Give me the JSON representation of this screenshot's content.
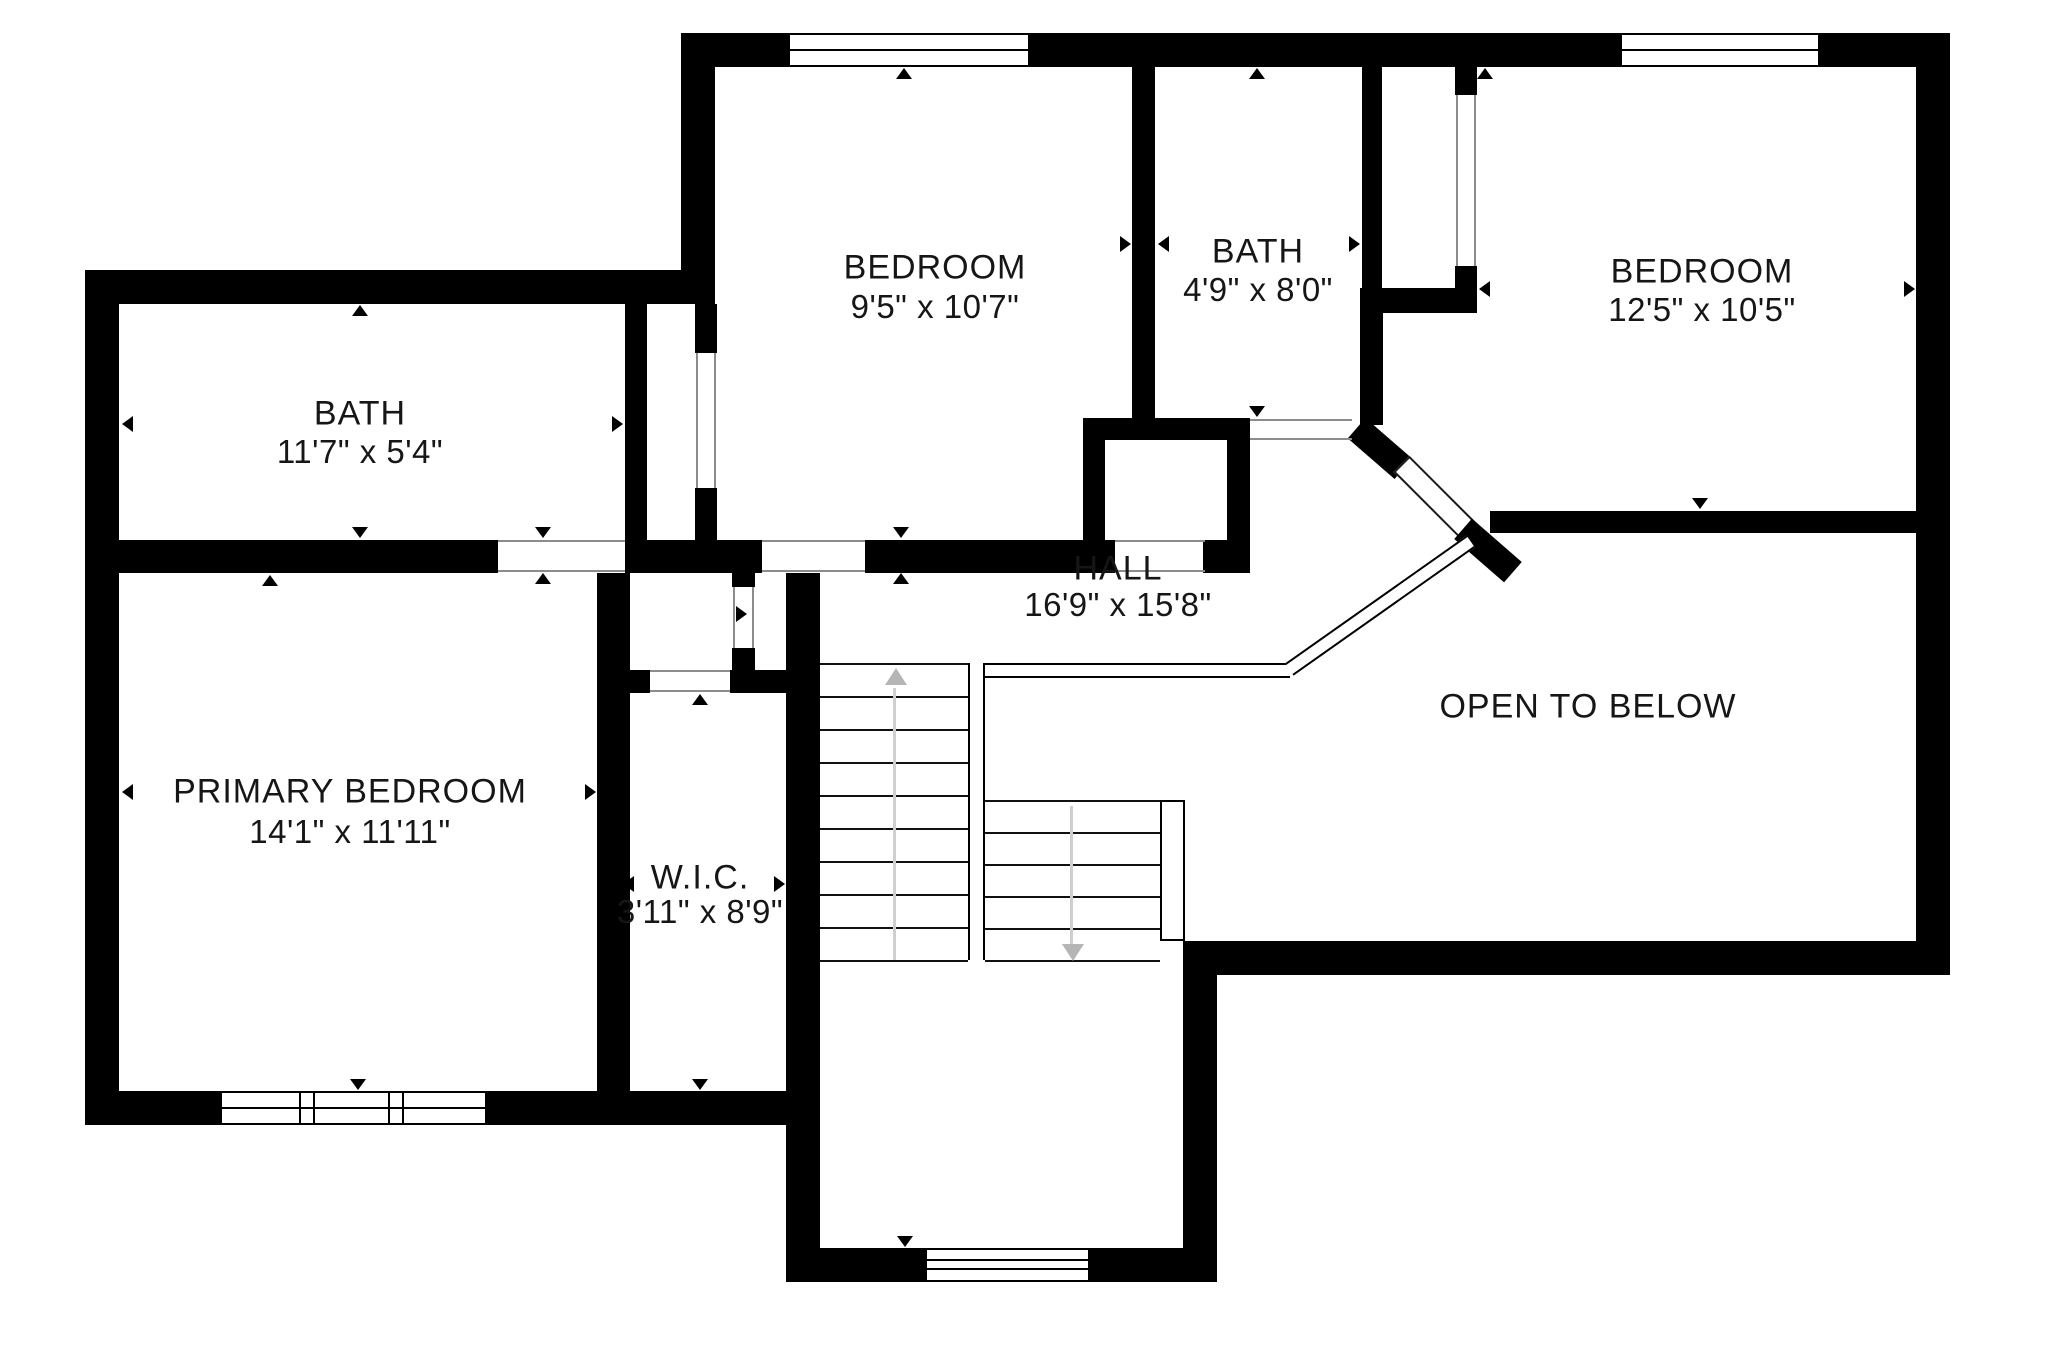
{
  "title": "Second floor plan",
  "style": {
    "background": "#ffffff",
    "wall_color": "#000000",
    "text_color": "#161616",
    "jamb_color": "#8c8c8c",
    "guide_stem_color": "#cfcfcf",
    "guide_head_color": "#b5b5b5"
  },
  "rooms": [
    {
      "id": "bath-upper-left",
      "name": "BATH",
      "dims": "11'7\" x 5'4\"",
      "label_x": 360,
      "name_y": 414,
      "dims_y": 452
    },
    {
      "id": "bedroom-middle",
      "name": "BEDROOM",
      "dims": "9'5\" x 10'7\"",
      "label_x": 935,
      "name_y": 268,
      "dims_y": 307
    },
    {
      "id": "bath-middle",
      "name": "BATH",
      "dims": "4'9\" x 8'0\"",
      "label_x": 1258,
      "name_y": 252,
      "dims_y": 290
    },
    {
      "id": "bedroom-right",
      "name": "BEDROOM",
      "dims": "12'5\" x 10'5\"",
      "label_x": 1702,
      "name_y": 272,
      "dims_y": 310
    },
    {
      "id": "hall",
      "name": "HALL",
      "dims": "16'9\" x 15'8\"",
      "label_x": 1118,
      "name_y": 569,
      "dims_y": 605
    },
    {
      "id": "open-to-below",
      "name": "OPEN TO BELOW",
      "dims": "",
      "label_x": 1588,
      "name_y": 707,
      "dims_y": 0
    },
    {
      "id": "primary-bedroom",
      "name": "PRIMARY BEDROOM",
      "dims": "14'1\" x 11'11\"",
      "label_x": 350,
      "name_y": 792,
      "dims_y": 832
    },
    {
      "id": "wic",
      "name": "W.I.C.",
      "dims": "3'11\" x 8'9\"",
      "label_x": 700,
      "name_y": 878,
      "dims_y": 912
    }
  ],
  "walls": [
    [
      85,
      270,
      34,
      855
    ],
    [
      85,
      270,
      630,
      34
    ],
    [
      85,
      1091,
      135,
      34
    ],
    [
      487,
      1091,
      333,
      34
    ],
    [
      681,
      33,
      34,
      271
    ],
    [
      681,
      33,
      107,
      34
    ],
    [
      1030,
      33,
      590,
      34
    ],
    [
      1820,
      33,
      130,
      34
    ],
    [
      1916,
      33,
      34,
      942
    ],
    [
      1183,
      941,
      767,
      34
    ],
    [
      1183,
      941,
      34,
      341
    ],
    [
      786,
      1248,
      139,
      34
    ],
    [
      1090,
      1248,
      127,
      34
    ],
    [
      786,
      1125,
      34,
      123
    ],
    [
      119,
      540,
      379,
      33
    ],
    [
      625,
      540,
      137,
      33
    ],
    [
      865,
      540,
      218,
      33
    ],
    [
      625,
      304,
      22,
      236
    ],
    [
      695,
      304,
      22,
      49
    ],
    [
      695,
      488,
      22,
      52
    ],
    [
      732,
      573,
      23,
      14
    ],
    [
      732,
      648,
      23,
      22
    ],
    [
      630,
      670,
      20,
      23
    ],
    [
      730,
      670,
      60,
      23
    ],
    [
      597,
      573,
      33,
      518
    ],
    [
      786,
      573,
      34,
      518
    ],
    [
      1132,
      67,
      23,
      351
    ],
    [
      1083,
      418,
      167,
      22
    ],
    [
      1083,
      440,
      22,
      133
    ],
    [
      1227,
      440,
      23,
      133
    ],
    [
      1083,
      540,
      32,
      33
    ],
    [
      1203,
      540,
      47,
      33
    ],
    [
      1362,
      67,
      20,
      221
    ],
    [
      1382,
      288,
      95,
      25
    ],
    [
      1455,
      67,
      22,
      28
    ],
    [
      1455,
      266,
      22,
      47
    ],
    [
      1360,
      288,
      23,
      137
    ],
    [
      1490,
      511,
      426,
      22
    ]
  ],
  "diagonal_walls": [
    {
      "x": 1349,
      "y": 435,
      "w": 62,
      "h": 27,
      "angle": 41,
      "kind": "wall"
    },
    {
      "x": 1387,
      "y": 487,
      "w": 98,
      "h": 23,
      "angle": 45,
      "kind": "door"
    },
    {
      "x": 1455,
      "y": 537,
      "w": 66,
      "h": 27,
      "angle": 41,
      "kind": "wall"
    }
  ],
  "windows": [
    {
      "x": 788,
      "y": 33,
      "w": 242,
      "h": 34,
      "type": "single"
    },
    {
      "x": 1620,
      "y": 33,
      "w": 200,
      "h": 34,
      "type": "single"
    },
    {
      "x": 220,
      "y": 1091,
      "w": 267,
      "h": 34,
      "type": "triple"
    },
    {
      "x": 925,
      "y": 1248,
      "w": 165,
      "h": 34,
      "type": "double-line"
    }
  ],
  "door_jambs": [
    [
      498,
      540,
      127,
      2
    ],
    [
      498,
      570,
      127,
      2
    ],
    [
      762,
      540,
      103,
      2
    ],
    [
      762,
      570,
      103,
      2
    ],
    [
      1115,
      540,
      90,
      2
    ],
    [
      1115,
      570,
      90,
      2
    ],
    [
      1250,
      419,
      102,
      2
    ],
    [
      1250,
      438,
      102,
      2
    ],
    [
      650,
      670,
      80,
      2
    ],
    [
      650,
      690,
      80,
      2
    ],
    [
      733,
      587,
      2,
      61
    ],
    [
      752,
      587,
      2,
      61
    ],
    [
      696,
      353,
      2,
      135
    ],
    [
      714,
      353,
      2,
      135
    ],
    [
      1456,
      95,
      2,
      171
    ],
    [
      1474,
      95,
      2,
      171
    ]
  ],
  "railings": [
    {
      "x": 985,
      "y": 663,
      "w": 305,
      "h": 15,
      "type": "h",
      "angle": 0
    },
    {
      "x": 1160,
      "y": 800,
      "w": 25,
      "h": 141,
      "type": "box",
      "angle": 0
    },
    {
      "x": 1269,
      "y": 598,
      "w": 222,
      "h": 15,
      "type": "h",
      "angle": -35.2
    }
  ],
  "stairs": {
    "left_flight": {
      "x": 820,
      "w": 148,
      "tread_ys": [
        663,
        696,
        729,
        762,
        795,
        828,
        861,
        894,
        927,
        960
      ],
      "direction": "up"
    },
    "right_flight": {
      "x": 985,
      "w": 175,
      "tread_ys": [
        800,
        832,
        864,
        896,
        928,
        960
      ],
      "direction": "down"
    },
    "divider": {
      "x": 968,
      "y": 663,
      "w": 17,
      "h": 297
    },
    "up_arrow": {
      "stem": [
        893,
        688,
        3,
        272
      ],
      "head_x": 885,
      "head_y": 668
    },
    "down_arrow": {
      "stem": [
        1070,
        806,
        3,
        140
      ],
      "head_x": 1062,
      "head_y": 944
    }
  },
  "dimension_arrows": [
    [
      "up",
      360,
      310
    ],
    [
      "down",
      360,
      532
    ],
    [
      "left",
      127,
      424
    ],
    [
      "right",
      617,
      424
    ],
    [
      "up",
      270,
      580
    ],
    [
      "down",
      358,
      1084
    ],
    [
      "left",
      127,
      792
    ],
    [
      "right",
      590,
      792
    ],
    [
      "up",
      904,
      73
    ],
    [
      "right",
      1125,
      244
    ],
    [
      "down",
      901,
      532
    ],
    [
      "up",
      901,
      578
    ],
    [
      "left",
      1163,
      244
    ],
    [
      "right",
      1354,
      244
    ],
    [
      "up",
      1257,
      73
    ],
    [
      "down",
      1257,
      411
    ],
    [
      "up",
      1485,
      73
    ],
    [
      "right",
      1909,
      289
    ],
    [
      "down",
      1700,
      503
    ],
    [
      "left",
      1484,
      289
    ],
    [
      "down",
      543,
      532
    ],
    [
      "up",
      543,
      578
    ],
    [
      "right",
      741,
      614
    ],
    [
      "up",
      700,
      699
    ],
    [
      "down",
      700,
      1084
    ],
    [
      "left",
      628,
      884
    ],
    [
      "right",
      779,
      884
    ],
    [
      "down",
      905,
      1241
    ]
  ]
}
